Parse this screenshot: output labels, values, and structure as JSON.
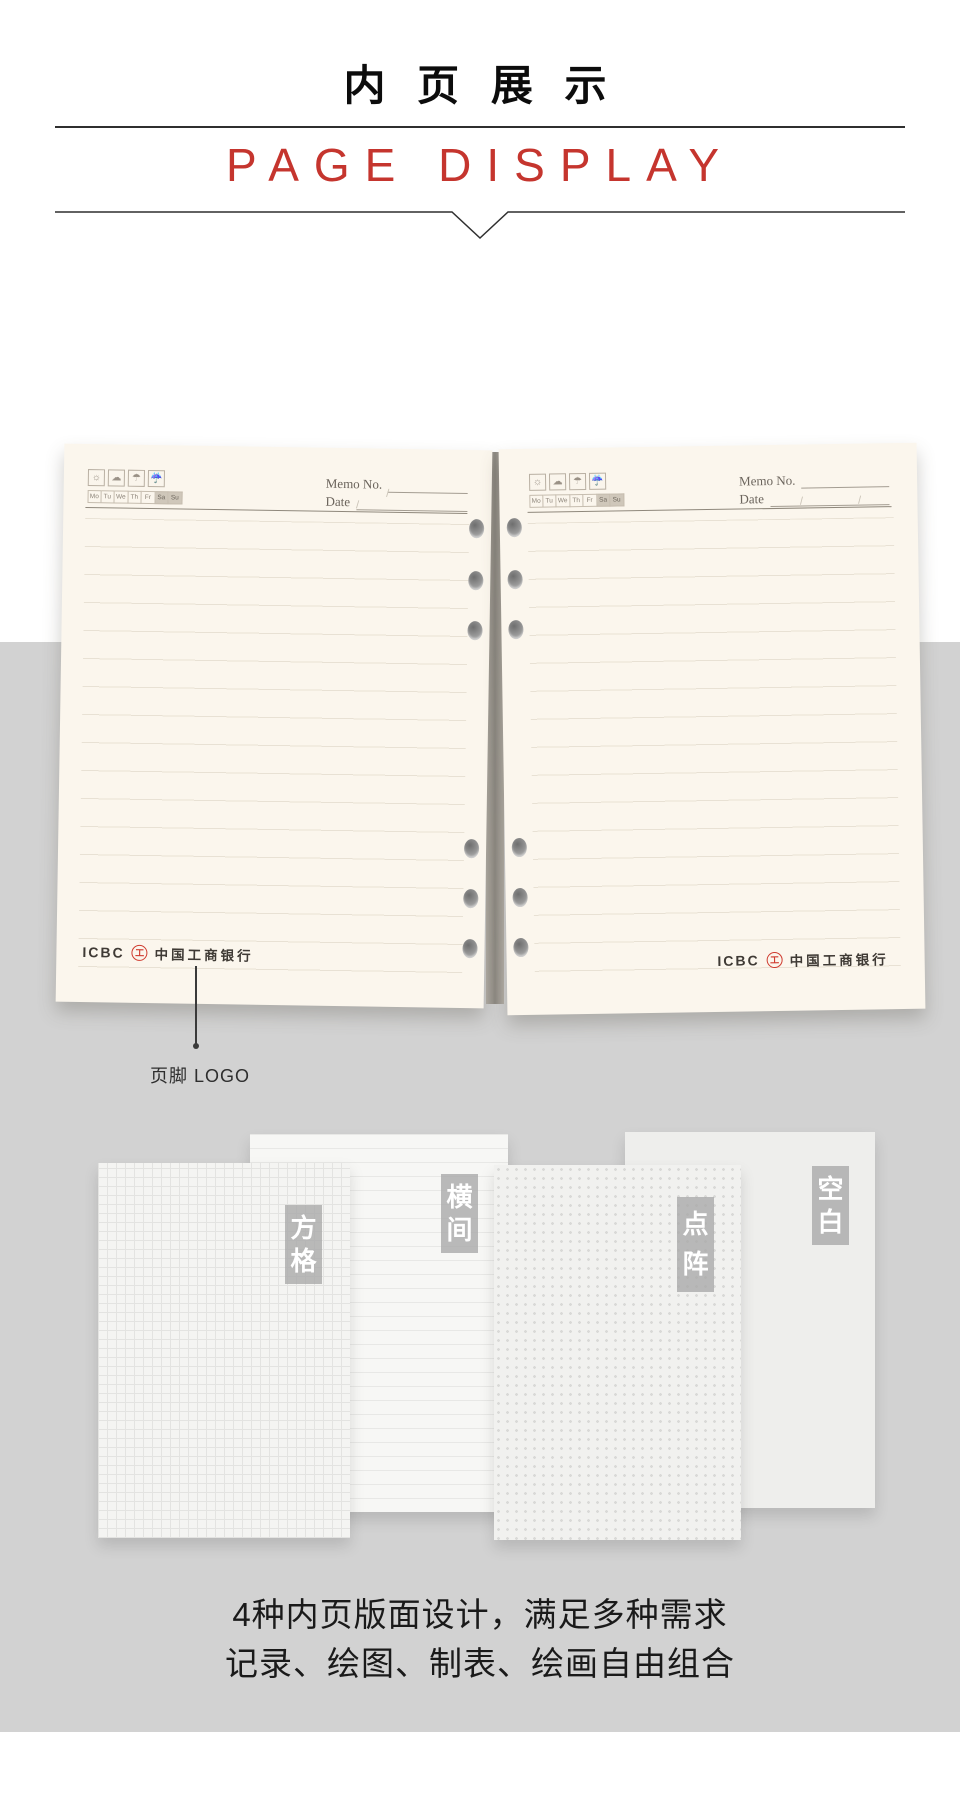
{
  "header": {
    "title_cn": "内 页 展 示",
    "title_en": "PAGE DISPLAY"
  },
  "page": {
    "memo_label": "Memo No.",
    "date_label": "Date",
    "date_slashes": "/ /",
    "weekdays": [
      "Mo",
      "Tu",
      "We",
      "Th",
      "Fr",
      "Sa",
      "Su"
    ],
    "weather_icons": [
      {
        "name": "sun-icon",
        "glyph": "☼"
      },
      {
        "name": "cloud-icon",
        "glyph": "☁"
      },
      {
        "name": "umbrella-icon",
        "glyph": "☂"
      },
      {
        "name": "rain-umbrella-icon",
        "glyph": "☔"
      }
    ],
    "footer": {
      "icbc": "ICBC",
      "logo_glyph": "工",
      "bank_name": "中国工商银行"
    }
  },
  "annotation": {
    "label": "页脚 LOGO"
  },
  "samples": [
    {
      "label": "方格",
      "pattern": "grid"
    },
    {
      "label": "横间",
      "pattern": "lines"
    },
    {
      "label": "点阵",
      "pattern": "dots"
    },
    {
      "label": "空白",
      "pattern": "blank"
    }
  ],
  "caption": {
    "line1": "4种内页版面设计，满足多种需求",
    "line2": "记录、绘图、制表、绘画自由组合"
  },
  "colors": {
    "accent_red": "#c5352e",
    "logo_red": "#cf3a2e",
    "gray_band": "#d2d2d2",
    "page_cream": "#fbf6ed"
  }
}
